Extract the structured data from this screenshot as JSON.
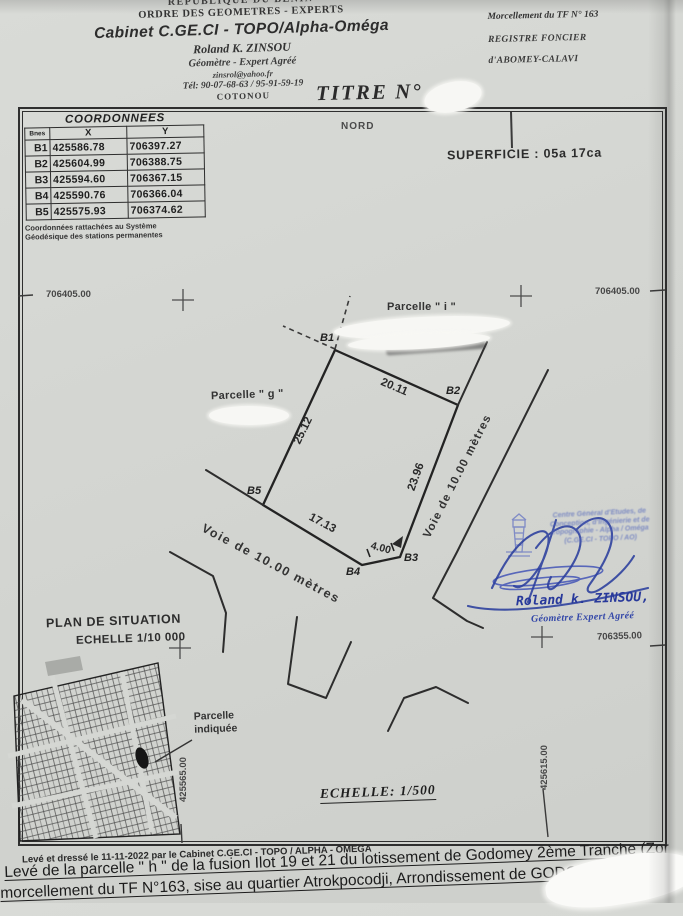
{
  "header": {
    "republic": "REPUBLIQUE DU BENIN",
    "order": "ORDRE DES GEOMETRES - EXPERTS",
    "cabinet": "Cabinet C.GE.CI - TOPO/Alpha-Oméga",
    "surveyor": "Roland K. ZINSOU",
    "surveyor_title": "Géomètre - Expert Agréé",
    "email": "zinsrol@yahoo.fr",
    "phone": "Tél: 90-07-68-63 / 95-91-59-19",
    "city": "COTONOU",
    "morcellement": "Morcellement du TF N° 163",
    "registre": "REGISTRE FONCIER",
    "registre_location": "d'ABOMEY-CALAVI",
    "titre_label": "TITRE N°"
  },
  "coord_table": {
    "title": "COORDONNEES",
    "col_borne": "Bnes",
    "col_x": "X",
    "col_y": "Y",
    "rows": [
      {
        "b": "B1",
        "x": "425586.78",
        "y": "706397.27"
      },
      {
        "b": "B2",
        "x": "425604.99",
        "y": "706388.75"
      },
      {
        "b": "B3",
        "x": "425594.60",
        "y": "706367.15"
      },
      {
        "b": "B4",
        "x": "425590.76",
        "y": "706366.04"
      },
      {
        "b": "B5",
        "x": "425575.93",
        "y": "706374.62"
      }
    ],
    "note1": "Coordonnées rattachées au Système",
    "note2": "Géodésique des stations permanentes"
  },
  "plan": {
    "north": "NORD",
    "superficie": "SUPERFICIE : 05a 17ca",
    "parcel_i": "Parcelle \" i \"",
    "parcel_g": "Parcelle \" g \"",
    "road_label": "Voie de 10.00 mètres",
    "vertices": {
      "b1": "B1",
      "b2": "B2",
      "b3": "B3",
      "b4": "B4",
      "b5": "B5"
    },
    "measures": {
      "b1b2": "20.11",
      "b2b3": "23.96",
      "b3b4": "4.00",
      "b4b5": "17.13",
      "b5b1": "25.12"
    },
    "grid": {
      "left_706405": "706405.00",
      "right_706405": "706405.00",
      "right_706355": "706355.00",
      "bottom_425565": "425565.00",
      "bottom_425615": "425615.00"
    },
    "scale": "ECHELLE: 1/500"
  },
  "situation": {
    "title": "PLAN DE SITUATION",
    "scale": "ECHELLE 1/10 000",
    "note_line1": "Parcelle",
    "note_line2": "indiquée"
  },
  "signature": {
    "stamp": [
      "Centre Général d'Etudes, de",
      "Conception, d'Ingénierie et de",
      "Topographie - Alpha / Oméga",
      "(C.GE.CI - TOPO / AO)"
    ],
    "name": "Roland k. ZINSOU,",
    "title": "Géomètre Expert Agréé"
  },
  "footer": {
    "made": "Levé et dressé le 11-11-2022 par le Cabinet C.GE.CI - TOPO / ALPHA - OMEGA",
    "line1": "Levé de la parcelle \" h \" de la fusion Ilot 19 et 21 du lotissement de Godomey 2ème Tranche (Zor",
    "line2": "morcellement du TF N°163, sise au quartier Atrokpocodji, Arrondissement de GODO"
  }
}
